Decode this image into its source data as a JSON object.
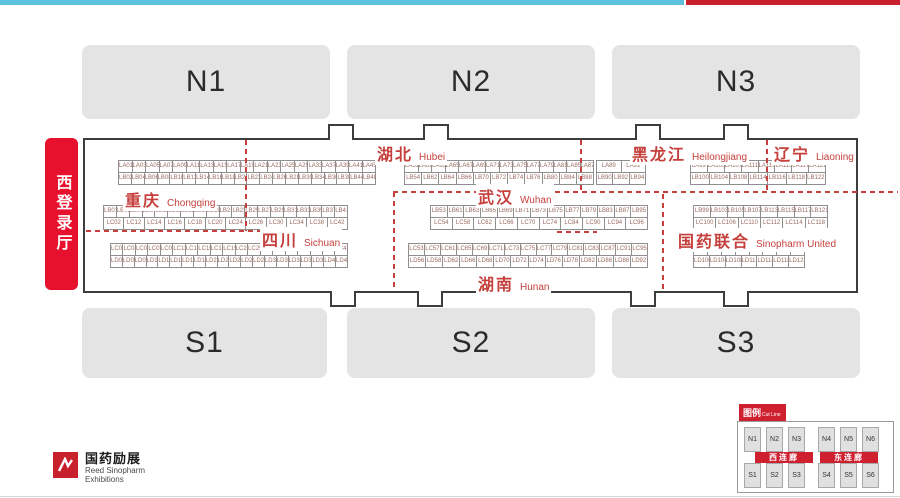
{
  "colors": {
    "top_bar_cyan": "#5cc1de",
    "top_bar_red": "#c9202e",
    "accent_red": "#c5403c",
    "entrance_red": "#e8112d",
    "hall_gray": "#e4e4e4",
    "legend_red": "#cf2030"
  },
  "west_entrance": {
    "label": "西登录厅"
  },
  "north_halls": [
    {
      "id": "N1"
    },
    {
      "id": "N2"
    },
    {
      "id": "N3"
    }
  ],
  "south_halls": [
    {
      "id": "S1"
    },
    {
      "id": "S2"
    },
    {
      "id": "S3"
    }
  ],
  "regions": [
    {
      "zh": "湖北",
      "en": "Hubei"
    },
    {
      "zh": "黑龙江",
      "en": "Heilongjiang"
    },
    {
      "zh": "辽宁",
      "en": "Liaoning"
    },
    {
      "zh": "重庆",
      "en": "Chongqing"
    },
    {
      "zh": "武汉",
      "en": "Wuhan"
    },
    {
      "zh": "四川",
      "en": "Sichuan"
    },
    {
      "zh": "国药联合",
      "en": "Sinopharm United"
    },
    {
      "zh": "湖南",
      "en": "Hunan"
    }
  ],
  "booth_tables": {
    "s1t1": {
      "top": [
        "LA01",
        "LA03",
        "LA05",
        "LA07",
        "LA09",
        "LA11",
        "LA13",
        "LA15",
        "LA17",
        "LA19",
        "LA21",
        "LA23",
        "LA25",
        "LA29",
        "LA33",
        "LA37",
        "LA39",
        "LA41",
        "LA45"
      ],
      "bottom": [
        "LB02",
        "LB04",
        "LB06",
        "LB08",
        "LB10",
        "LB12",
        "LB14",
        "LB16",
        "LB18",
        "LB20",
        "LB22",
        "LB24",
        "LB26",
        "LB28",
        "LB30",
        "LB34",
        "LB36",
        "LB38",
        "LB44",
        "LB48"
      ]
    },
    "s1t2": {
      "top": [
        "LA51",
        "LA61",
        "LA63",
        "LA65",
        "LA67",
        "LA69",
        "LA71",
        "LA73",
        "LA75",
        "LA77",
        "LA79",
        "LA81",
        "LA85",
        "LA87"
      ],
      "bottom": [
        "LB54",
        "LB62",
        "LB64",
        "LB66",
        "LB70",
        "LB72",
        "LB74",
        "LB76",
        "LB80",
        "LB84",
        "LB88"
      ]
    },
    "s1t3": {
      "top": [
        "LA89",
        "LA91"
      ],
      "bottom": [
        "LB90",
        "LB92",
        "LB94"
      ]
    },
    "s1t4": {
      "top": [
        "LA99",
        "LA103",
        "LA107",
        "LA111",
        "LA113",
        "LA115",
        "LA117",
        "LA121"
      ],
      "bottom": [
        "LB100",
        "LB104",
        "LB108",
        "LB114",
        "LB116",
        "LB118",
        "LB122"
      ]
    },
    "s2t1": {
      "top": [
        "LB01",
        "LB05",
        "LB07",
        "LB09",
        "LB11",
        "LB13",
        "LB15",
        "LB17",
        "LB19",
        "LB21",
        "LB23",
        "LB25",
        "LB27",
        "LB29",
        "LB31",
        "LB33",
        "LB35",
        "LB37",
        "LB41"
      ],
      "bottom": [
        "LC02",
        "LC12",
        "LC14",
        "LC16",
        "LC18",
        "LC20",
        "LC24",
        "LC26",
        "LC30",
        "LC34",
        "LC38",
        "LC42"
      ]
    },
    "s2t2": {
      "top": [
        "LB53",
        "LB61",
        "LB63",
        "LB65",
        "LB69",
        "LB71",
        "LB73",
        "LB75",
        "LB77",
        "LB79",
        "LB83",
        "LB87",
        "LB95"
      ],
      "bottom": [
        "LC54",
        "LC58",
        "LC62",
        "LC66",
        "LC70",
        "LC74",
        "LC84",
        "LC90",
        "LC94",
        "LC96"
      ]
    },
    "s2t3": {
      "top": [
        "LB99",
        "LB103",
        "LB105",
        "LB107",
        "LB113",
        "LB115",
        "LB117",
        "LB121"
      ],
      "bottom": [
        "LC100",
        "LC106",
        "LC110",
        "LC112",
        "LC114",
        "LC118"
      ]
    },
    "s3t1": {
      "top": [
        "LC01",
        "LC03",
        "LC05",
        "LC07",
        "LC09",
        "LC11",
        "LC13",
        "LC15",
        "LC17",
        "LC19",
        "LC21",
        "LC25",
        "LC27",
        "LC29",
        "LC31",
        "LC33",
        "LC37",
        "LC39",
        "LC43"
      ],
      "bottom": [
        "LD02",
        "LD06",
        "LD08",
        "LD10",
        "LD12",
        "LD14",
        "LD16",
        "LD18",
        "LD20",
        "LD22",
        "LD24",
        "LD26",
        "LD28",
        "LD30",
        "LD32",
        "LD34",
        "LD36",
        "LD38",
        "LD42",
        "LD46"
      ]
    },
    "s3t2": {
      "top": [
        "LC53",
        "LC57",
        "LC61",
        "LC65",
        "LC69",
        "LC71",
        "LC73",
        "LC75",
        "LC77",
        "LC79",
        "LC81",
        "LC83",
        "LC87",
        "LC91",
        "LC95"
      ],
      "bottom": [
        "LD56",
        "LD58",
        "LD62",
        "LD66",
        "LD68",
        "LD70",
        "LD72",
        "LD74",
        "LD76",
        "LD78",
        "LD82",
        "LD86",
        "LD88",
        "LD92"
      ]
    },
    "s3t3": {
      "top": [
        "LC99",
        "LC105",
        "LC107",
        "LC109",
        "LC111",
        "LC113",
        "LC115",
        "LC119"
      ],
      "bottom": [
        "LD100",
        "LD104",
        "LD108",
        "LD112",
        "LD114",
        "LD118",
        "LD122"
      ]
    }
  },
  "legend": {
    "title_zh": "图例",
    "title_en": "Cut Line",
    "north": [
      "N1",
      "N2",
      "N3",
      "N4",
      "N5",
      "N6"
    ],
    "south": [
      "S1",
      "S2",
      "S3",
      "S4",
      "S5",
      "S6"
    ],
    "corridors": [
      "西连廊",
      "东连廊"
    ]
  },
  "logo": {
    "zh": "国药励展",
    "en_line1": "Reed Sinopharm",
    "en_line2": "Exhibitions"
  }
}
